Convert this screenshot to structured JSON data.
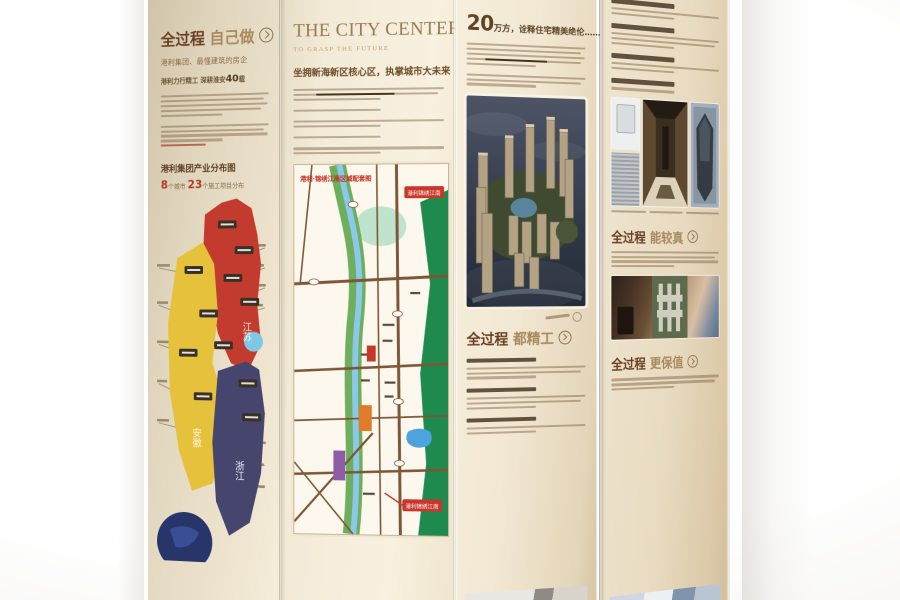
{
  "scene": {
    "description": "Photograph of an accordion-folded real-estate brochure standing upright on a white surface"
  },
  "colors": {
    "paper_cream": "#f3ebd8",
    "text_brown": "#8a6f4e",
    "heading_dark_brown": "#693f22",
    "accent_red": "#b23c28",
    "map_red_region": "#c23b2e",
    "map_yellow_region": "#e6c23c",
    "map_navy_region": "#45456e",
    "map_cyan_region": "#7ec8e3"
  },
  "icons": {
    "arrow": "chevron-right-in-circle"
  },
  "panel1": {
    "heading_strong": "全过程",
    "heading_light": "自己做",
    "subheading": "港利集团、最懂建筑的房企",
    "tagline_pre": "港利力行精工 深耕淮安",
    "tagline_num": "40",
    "tagline_post": "载",
    "map_title": "港利集团产业分布图",
    "stat_n1": "8",
    "stat_t1": "个城市 ",
    "stat_n2": "23",
    "stat_t2": "个施工项目分布",
    "regions": {
      "jiangsu": "江苏",
      "anhui": "安徽",
      "zhejiang": "浙江"
    }
  },
  "panel2": {
    "title": "THE CITY CENTER",
    "subtitle": "TO GRASP THE FUTURE",
    "heading_cn": "坐拥新海新区核心区，执掌城市大未来",
    "map_title": "港利·锦绣江南区域配套图",
    "callout_top": "港利锦绣江南",
    "callout_bottom": "港利锦绣江南"
  },
  "panel3": {
    "big_num": "20",
    "heading_rest": "万方，诠释住宅精美绝伦……",
    "process_strong": "全过程",
    "process_light": "都精工"
  },
  "panel4": {
    "process1_strong": "全过程",
    "process1_light": "能较真",
    "process2_strong": "全过程",
    "process2_light": "更保值"
  }
}
